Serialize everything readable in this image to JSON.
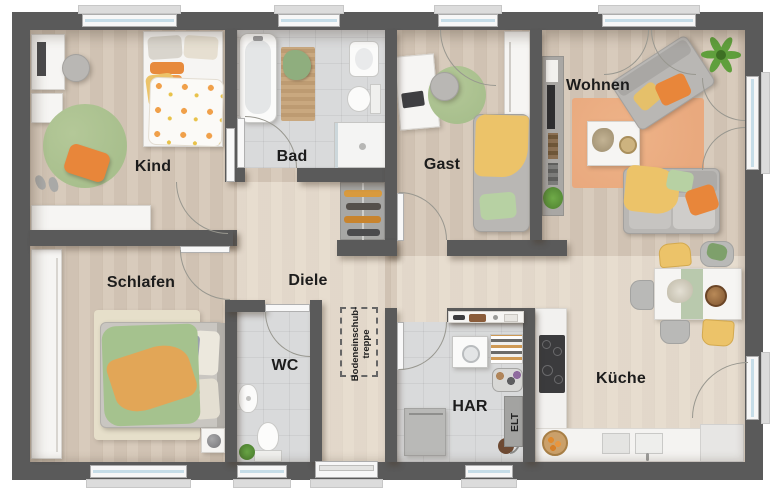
{
  "title": "Bungalow Grundriss",
  "rooms": {
    "kind": {
      "label": "Kind"
    },
    "bad": {
      "label": "Bad"
    },
    "gast": {
      "label": "Gast"
    },
    "wohnen": {
      "label": "Wohnen"
    },
    "schlafen": {
      "label": "Schlafen"
    },
    "diele": {
      "label": "Diele"
    },
    "wc": {
      "label": "WC"
    },
    "har": {
      "label": "HAR"
    },
    "kueche": {
      "label": "Küche"
    },
    "elt": {
      "label": "ELT"
    },
    "treppe": {
      "label_line1": "Bodeneinschub-",
      "label_line2": "treppe"
    }
  },
  "colors": {
    "wall": "#5a5a5a",
    "wood": "#d5c7b7",
    "woodlight": "#ded2c2",
    "tile": "#d9dadb",
    "green": "#a8bf8d",
    "orange": "#e8863a",
    "yellow": "#ecc369",
    "rugorange": "#e9a97e",
    "glass": "#c6dde8",
    "ink": "#1c1c1c"
  }
}
